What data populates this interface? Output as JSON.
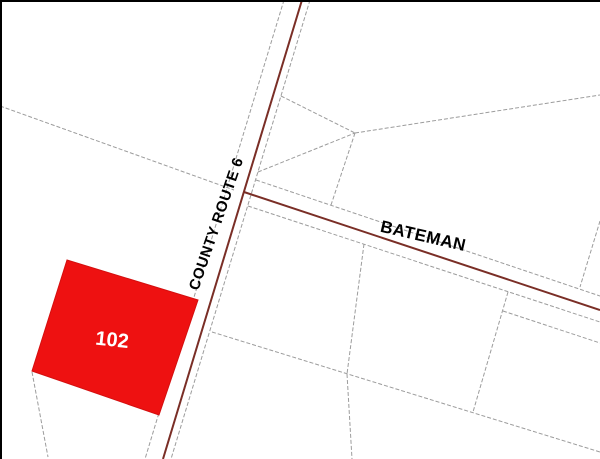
{
  "map": {
    "description": "parcel map with highlighted lot at road intersection",
    "roads": [
      {
        "name": "COUNTY ROUTE 6",
        "orientation": "vertical",
        "centerline_color": "#7a2e26"
      },
      {
        "name": "BATEMAN",
        "orientation": "diagonal-right",
        "centerline_color": "#7a2e26"
      }
    ],
    "selected_parcel": {
      "id": "102",
      "fill_color": "#ee1111",
      "label_color": "#ffffff"
    },
    "colors": {
      "background": "#ffffff",
      "boundary_line": "#9c9c9c",
      "road_centerline": "#7a2e26",
      "road_label": "#000000",
      "frame_border": "#000000"
    }
  }
}
